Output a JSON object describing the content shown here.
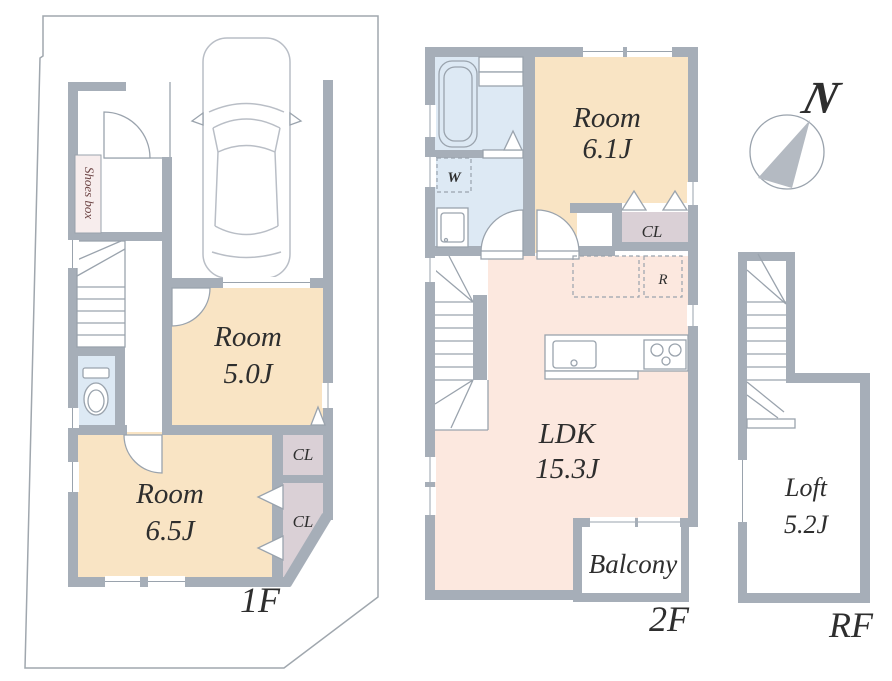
{
  "colors": {
    "wall": "#a6aeb8",
    "line": "#9aa3ad",
    "room_fill": "#f9e4c4",
    "ldk_fill": "#fce8df",
    "water_fill": "#dde9f4",
    "closet_fill": "#dad0d6",
    "shoes_fill": "#f7eded",
    "text": "#2e2e2e",
    "shoes_text": "#6d4545",
    "compass_fill": "#b4bac2"
  },
  "floor1": {
    "label": "1F",
    "shoes_box": "Shoes box",
    "room_a": {
      "name": "Room",
      "size": "5.0J"
    },
    "room_b": {
      "name": "Room",
      "size": "6.5J"
    },
    "closet_a": "CL",
    "closet_b": "CL"
  },
  "floor2": {
    "label": "2F",
    "room_c": {
      "name": "Room",
      "size": "6.1J"
    },
    "ldk": {
      "name": "LDK",
      "size": "15.3J"
    },
    "balcony": "Balcony",
    "closet": "CL",
    "washer": "W",
    "fridge": "R"
  },
  "roof": {
    "label": "RF",
    "loft": {
      "name": "Loft",
      "size": "5.2J"
    }
  },
  "compass": {
    "north": "N"
  }
}
